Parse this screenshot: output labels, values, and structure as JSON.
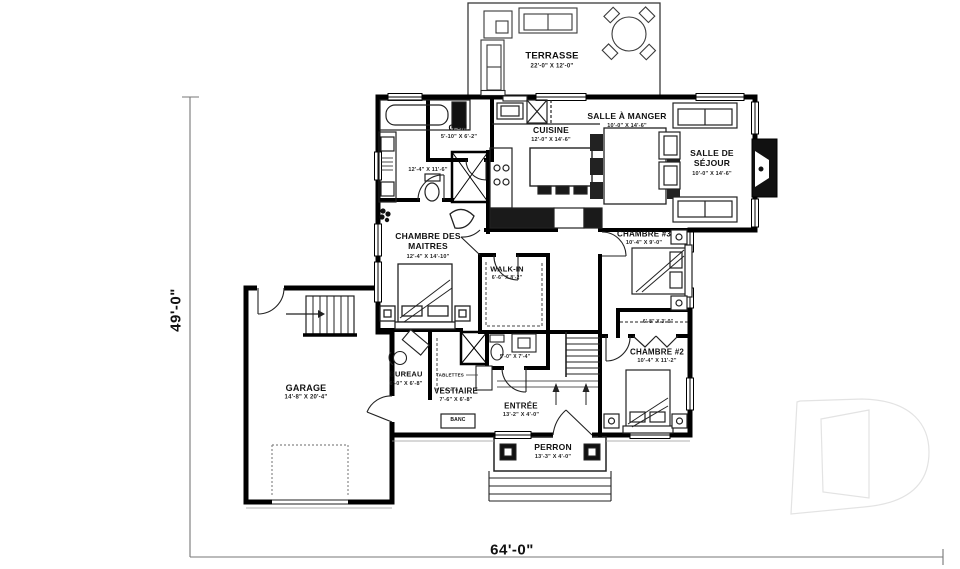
{
  "rooms": {
    "terrasse": {
      "name": "TERRASSE",
      "dims": "22'-0\" X 12'-0\""
    },
    "garde_manger": {
      "name": "G.-M.",
      "dims": "5'-10\" X 6'-2\""
    },
    "cuisine": {
      "name": "CUISINE",
      "dims": "12'-0\" X 14'-6\""
    },
    "salle_a_manger": {
      "name": "SALLE À MANGER",
      "dims": "10'-0\" X 14'-6\""
    },
    "salle_de_sejour": {
      "name": "SALLE DE SÉJOUR",
      "dims": "10'-0\" X 14'-6\""
    },
    "salle_de_bain": {
      "dims": "12'-4\" X 11'-6\""
    },
    "chambre_des_maitres": {
      "name": "CHAMBRE DES MAITRES",
      "dims": "12'-4\" X 14'-10\""
    },
    "walk_in": {
      "name": "WALK-IN",
      "dims": "6'-6\" X 8'-2\""
    },
    "salle_eau": {
      "dims": "5'-0\" X 7'-4\""
    },
    "chambre_3": {
      "name": "CHAMBRE #3",
      "dims": "10'-4\" X 9'-0\""
    },
    "penderie": {
      "dims": "6'-8\" X 3'-0\""
    },
    "chambre_2": {
      "name": "CHAMBRE #2",
      "dims": "10'-4\" X 11'-2\""
    },
    "garage": {
      "name": "GARAGE",
      "dims": "14'-8\" X 20'-4\""
    },
    "bureau": {
      "name": "BUREAU",
      "dims": "6'-0\" X 6'-8\""
    },
    "vestiaire": {
      "name": "VESTIAIRE",
      "dims": "7'-6\" X 6'-8\""
    },
    "entree": {
      "name": "ENTRÉE",
      "dims": "13'-2\" X 4'-0\""
    },
    "perron": {
      "name": "PERRON",
      "dims": "13'-3\" X 4'-0\""
    }
  },
  "labels": {
    "tablettes": "TABLETTES",
    "banc": "BANC"
  },
  "overall_dimensions": {
    "width": "64'-0\"",
    "height": "49'-0\""
  },
  "colors": {
    "wall": "#000000",
    "counter": "#1a1a1a",
    "watermark": "#e3e3e3",
    "paper": "#ffffff"
  }
}
